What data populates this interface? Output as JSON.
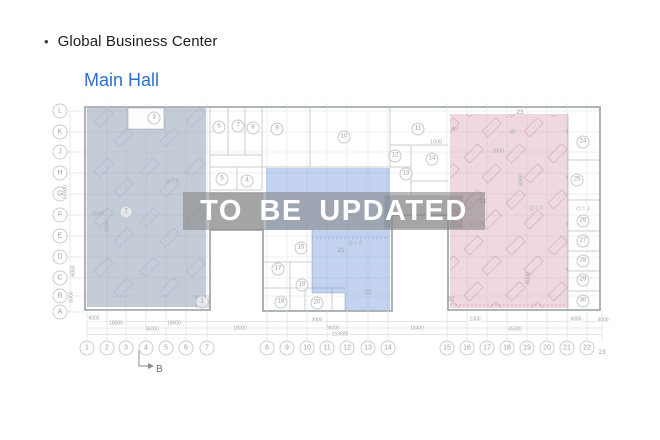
{
  "header": {
    "bullet": "•",
    "title": "Global Business Center",
    "hall_link": "Main Hall"
  },
  "watermark": {
    "text": "TO BE UPDATED"
  },
  "colors": {
    "link_blue": "#2e6fce",
    "region_left": "rgba(125,143,166,0.45)",
    "region_middle": "rgba(110,148,216,0.42)",
    "region_right": "rgba(208,138,160,0.33)",
    "band": "rgba(125,125,125,0.52)"
  },
  "plan": {
    "section_marker": "B",
    "row_labels": [
      {
        "t": "L",
        "y": 111
      },
      {
        "t": "K",
        "y": 132
      },
      {
        "t": "J",
        "y": 152
      },
      {
        "t": "H",
        "y": 173
      },
      {
        "t": "G",
        "y": 194
      },
      {
        "t": "F",
        "y": 215
      },
      {
        "t": "E",
        "y": 236
      },
      {
        "t": "D",
        "y": 257
      },
      {
        "t": "C",
        "y": 278
      },
      {
        "t": "B",
        "y": 296
      },
      {
        "t": "A",
        "y": 312
      }
    ],
    "col_labels": [
      {
        "t": "1",
        "x": 87
      },
      {
        "t": "2",
        "x": 107
      },
      {
        "t": "3",
        "x": 126
      },
      {
        "t": "4",
        "x": 146
      },
      {
        "t": "5",
        "x": 166
      },
      {
        "t": "6",
        "x": 186
      },
      {
        "t": "7",
        "x": 207
      },
      {
        "t": "8",
        "x": 267
      },
      {
        "t": "9",
        "x": 287
      },
      {
        "t": "10",
        "x": 307
      },
      {
        "t": "11",
        "x": 327
      },
      {
        "t": "12",
        "x": 347
      },
      {
        "t": "13",
        "x": 368
      },
      {
        "t": "14",
        "x": 388
      },
      {
        "t": "15",
        "x": 447
      },
      {
        "t": "16",
        "x": 467
      },
      {
        "t": "17",
        "x": 487
      },
      {
        "t": "18",
        "x": 507
      },
      {
        "t": "19",
        "x": 527
      },
      {
        "t": "20",
        "x": 547
      },
      {
        "t": "21",
        "x": 567
      },
      {
        "t": "22",
        "x": 587
      },
      {
        "t": "23",
        "x": 602,
        "plain": true,
        "dy": 5
      }
    ],
    "rooms": [
      {
        "t": "1",
        "x": 202,
        "y": 302
      },
      {
        "t": "2",
        "x": 126,
        "y": 212
      },
      {
        "t": "3",
        "x": 154,
        "y": 118
      },
      {
        "t": "4",
        "x": 247,
        "y": 181
      },
      {
        "t": "5",
        "x": 222,
        "y": 179
      },
      {
        "t": "6",
        "x": 219,
        "y": 127
      },
      {
        "t": "7",
        "x": 238,
        "y": 126
      },
      {
        "t": "8",
        "x": 253,
        "y": 128
      },
      {
        "t": "9",
        "x": 277,
        "y": 129
      },
      {
        "t": "10",
        "x": 344,
        "y": 137
      },
      {
        "t": "11",
        "x": 418,
        "y": 129
      },
      {
        "t": "12",
        "x": 395,
        "y": 156
      },
      {
        "t": "13",
        "x": 406,
        "y": 174
      },
      {
        "t": "14",
        "x": 432,
        "y": 159
      },
      {
        "t": "15",
        "x": 301,
        "y": 248
      },
      {
        "t": "17",
        "x": 278,
        "y": 269
      },
      {
        "t": "18",
        "x": 281,
        "y": 302
      },
      {
        "t": "19",
        "x": 302,
        "y": 285
      },
      {
        "t": "20",
        "x": 317,
        "y": 303
      },
      {
        "t": "24",
        "x": 583,
        "y": 142
      },
      {
        "t": "25",
        "x": 577,
        "y": 180
      },
      {
        "t": "26",
        "x": 583,
        "y": 221
      },
      {
        "t": "27",
        "x": 583,
        "y": 241
      },
      {
        "t": "28",
        "x": 583,
        "y": 261
      },
      {
        "t": "29",
        "x": 583,
        "y": 280
      },
      {
        "t": "30",
        "x": 583,
        "y": 301
      }
    ],
    "room_texts": [
      {
        "t": "21",
        "x": 341,
        "y": 251
      },
      {
        "t": "22",
        "x": 368,
        "y": 293
      },
      {
        "t": "23",
        "x": 520,
        "y": 113
      },
      {
        "t": "31",
        "x": 483,
        "y": 202
      },
      {
        "t": "32",
        "x": 451,
        "y": 300
      }
    ],
    "annotations": [
      {
        "t": "Q = 3",
        "x": 172,
        "y": 182
      },
      {
        "t": "Q = 3",
        "x": 355,
        "y": 244
      },
      {
        "t": "Q = 3",
        "x": 536,
        "y": 209
      },
      {
        "t": "Q = 3",
        "x": 476,
        "y": 225
      },
      {
        "t": "O = 3",
        "x": 583,
        "y": 210
      },
      {
        "t": "45°",
        "x": 455,
        "y": 130
      },
      {
        "t": "45°",
        "x": 513,
        "y": 133
      },
      {
        "t": "1000",
        "x": 436,
        "y": 143
      },
      {
        "t": "1800",
        "x": 498,
        "y": 152
      },
      {
        "t": "2000",
        "x": 98,
        "y": 215
      },
      {
        "t": "3000",
        "x": 108,
        "y": 226,
        "rot": true
      },
      {
        "t": "6000",
        "x": 522,
        "y": 180,
        "rot": true
      },
      {
        "t": "6000",
        "x": 529,
        "y": 278,
        "rot": true
      }
    ],
    "dims_bottom": [
      {
        "t": "6000",
        "x": 94,
        "y": 319
      },
      {
        "t": "18000",
        "x": 116,
        "y": 324
      },
      {
        "t": "18000",
        "x": 174,
        "y": 324
      },
      {
        "t": "36000",
        "x": 152,
        "y": 330
      },
      {
        "t": "18000",
        "x": 240,
        "y": 329
      },
      {
        "t": "2000",
        "x": 317,
        "y": 321
      },
      {
        "t": "36000",
        "x": 333,
        "y": 329
      },
      {
        "t": "153600",
        "x": 340,
        "y": 335
      },
      {
        "t": "1300",
        "x": 475,
        "y": 320
      },
      {
        "t": "18400",
        "x": 417,
        "y": 329
      },
      {
        "t": "45000",
        "x": 515,
        "y": 330
      },
      {
        "t": "6000",
        "x": 576,
        "y": 320
      },
      {
        "t": "3000",
        "x": 603,
        "y": 321
      }
    ],
    "dims_left": [
      {
        "t": "60000",
        "x": 66,
        "y": 192,
        "rot": true
      },
      {
        "t": "6000",
        "x": 74,
        "y": 271,
        "rot": true
      },
      {
        "t": "6000",
        "x": 72,
        "y": 297,
        "rot": true
      }
    ]
  }
}
